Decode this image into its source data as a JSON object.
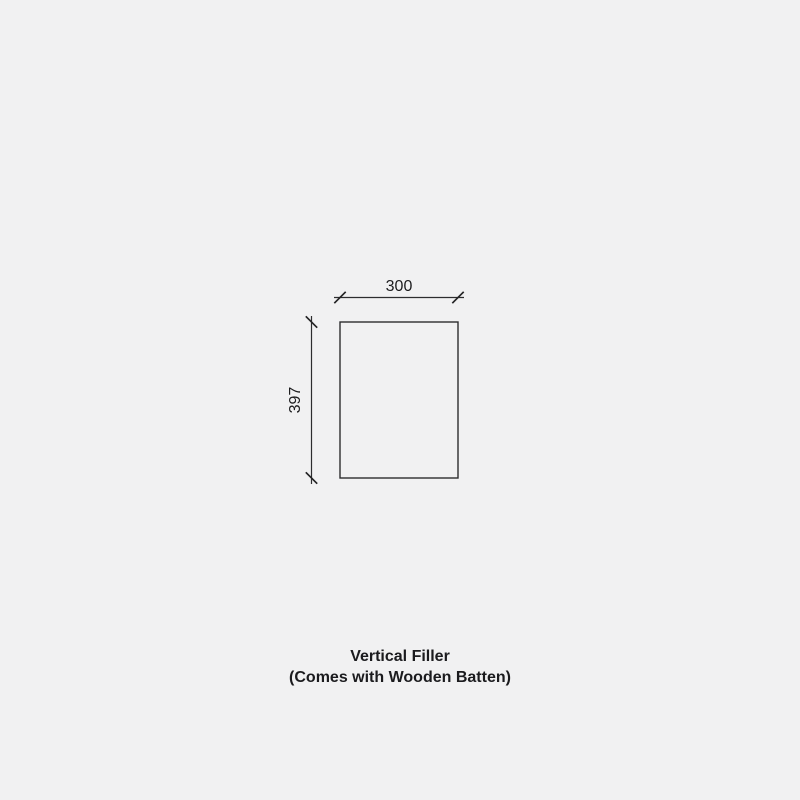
{
  "page": {
    "background_color": "#f1f1f2",
    "line_color": "#2d2d2f",
    "text_color": "#1b1b1e"
  },
  "drawing": {
    "shape": "rectangle-outline",
    "width_dimension": {
      "label": "300",
      "value": 300
    },
    "height_dimension": {
      "label": "397",
      "value": 397
    }
  },
  "caption": {
    "line1": "Vertical Filler",
    "line2": "(Comes with Wooden Batten)"
  }
}
